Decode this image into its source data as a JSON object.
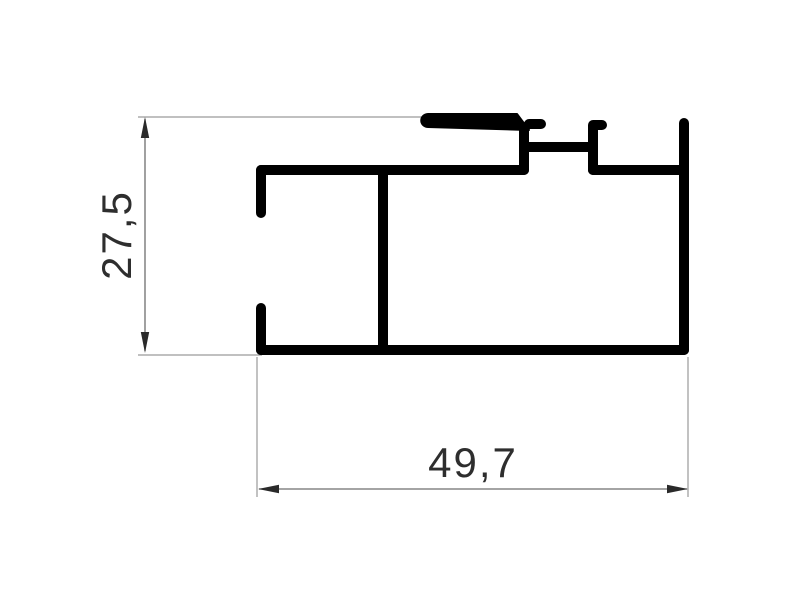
{
  "figure": {
    "title": "aluminum profile cross-section technical drawing",
    "type": "technical-drawing",
    "background": "white",
    "dimensions": [
      {
        "id": "height",
        "label": "27,5",
        "orientation": "vertical",
        "side": "left"
      },
      {
        "id": "width",
        "label": "49,7",
        "orientation": "horizontal",
        "side": "bottom"
      }
    ]
  },
  "colors": {
    "background": "#ffffff",
    "profile_stroke": "#000000",
    "dimension_line": "#6e6e6e",
    "extension_line": "#9a9a9a",
    "arrow_fill": "#2a2a2a",
    "text": "#2e2e2e"
  }
}
